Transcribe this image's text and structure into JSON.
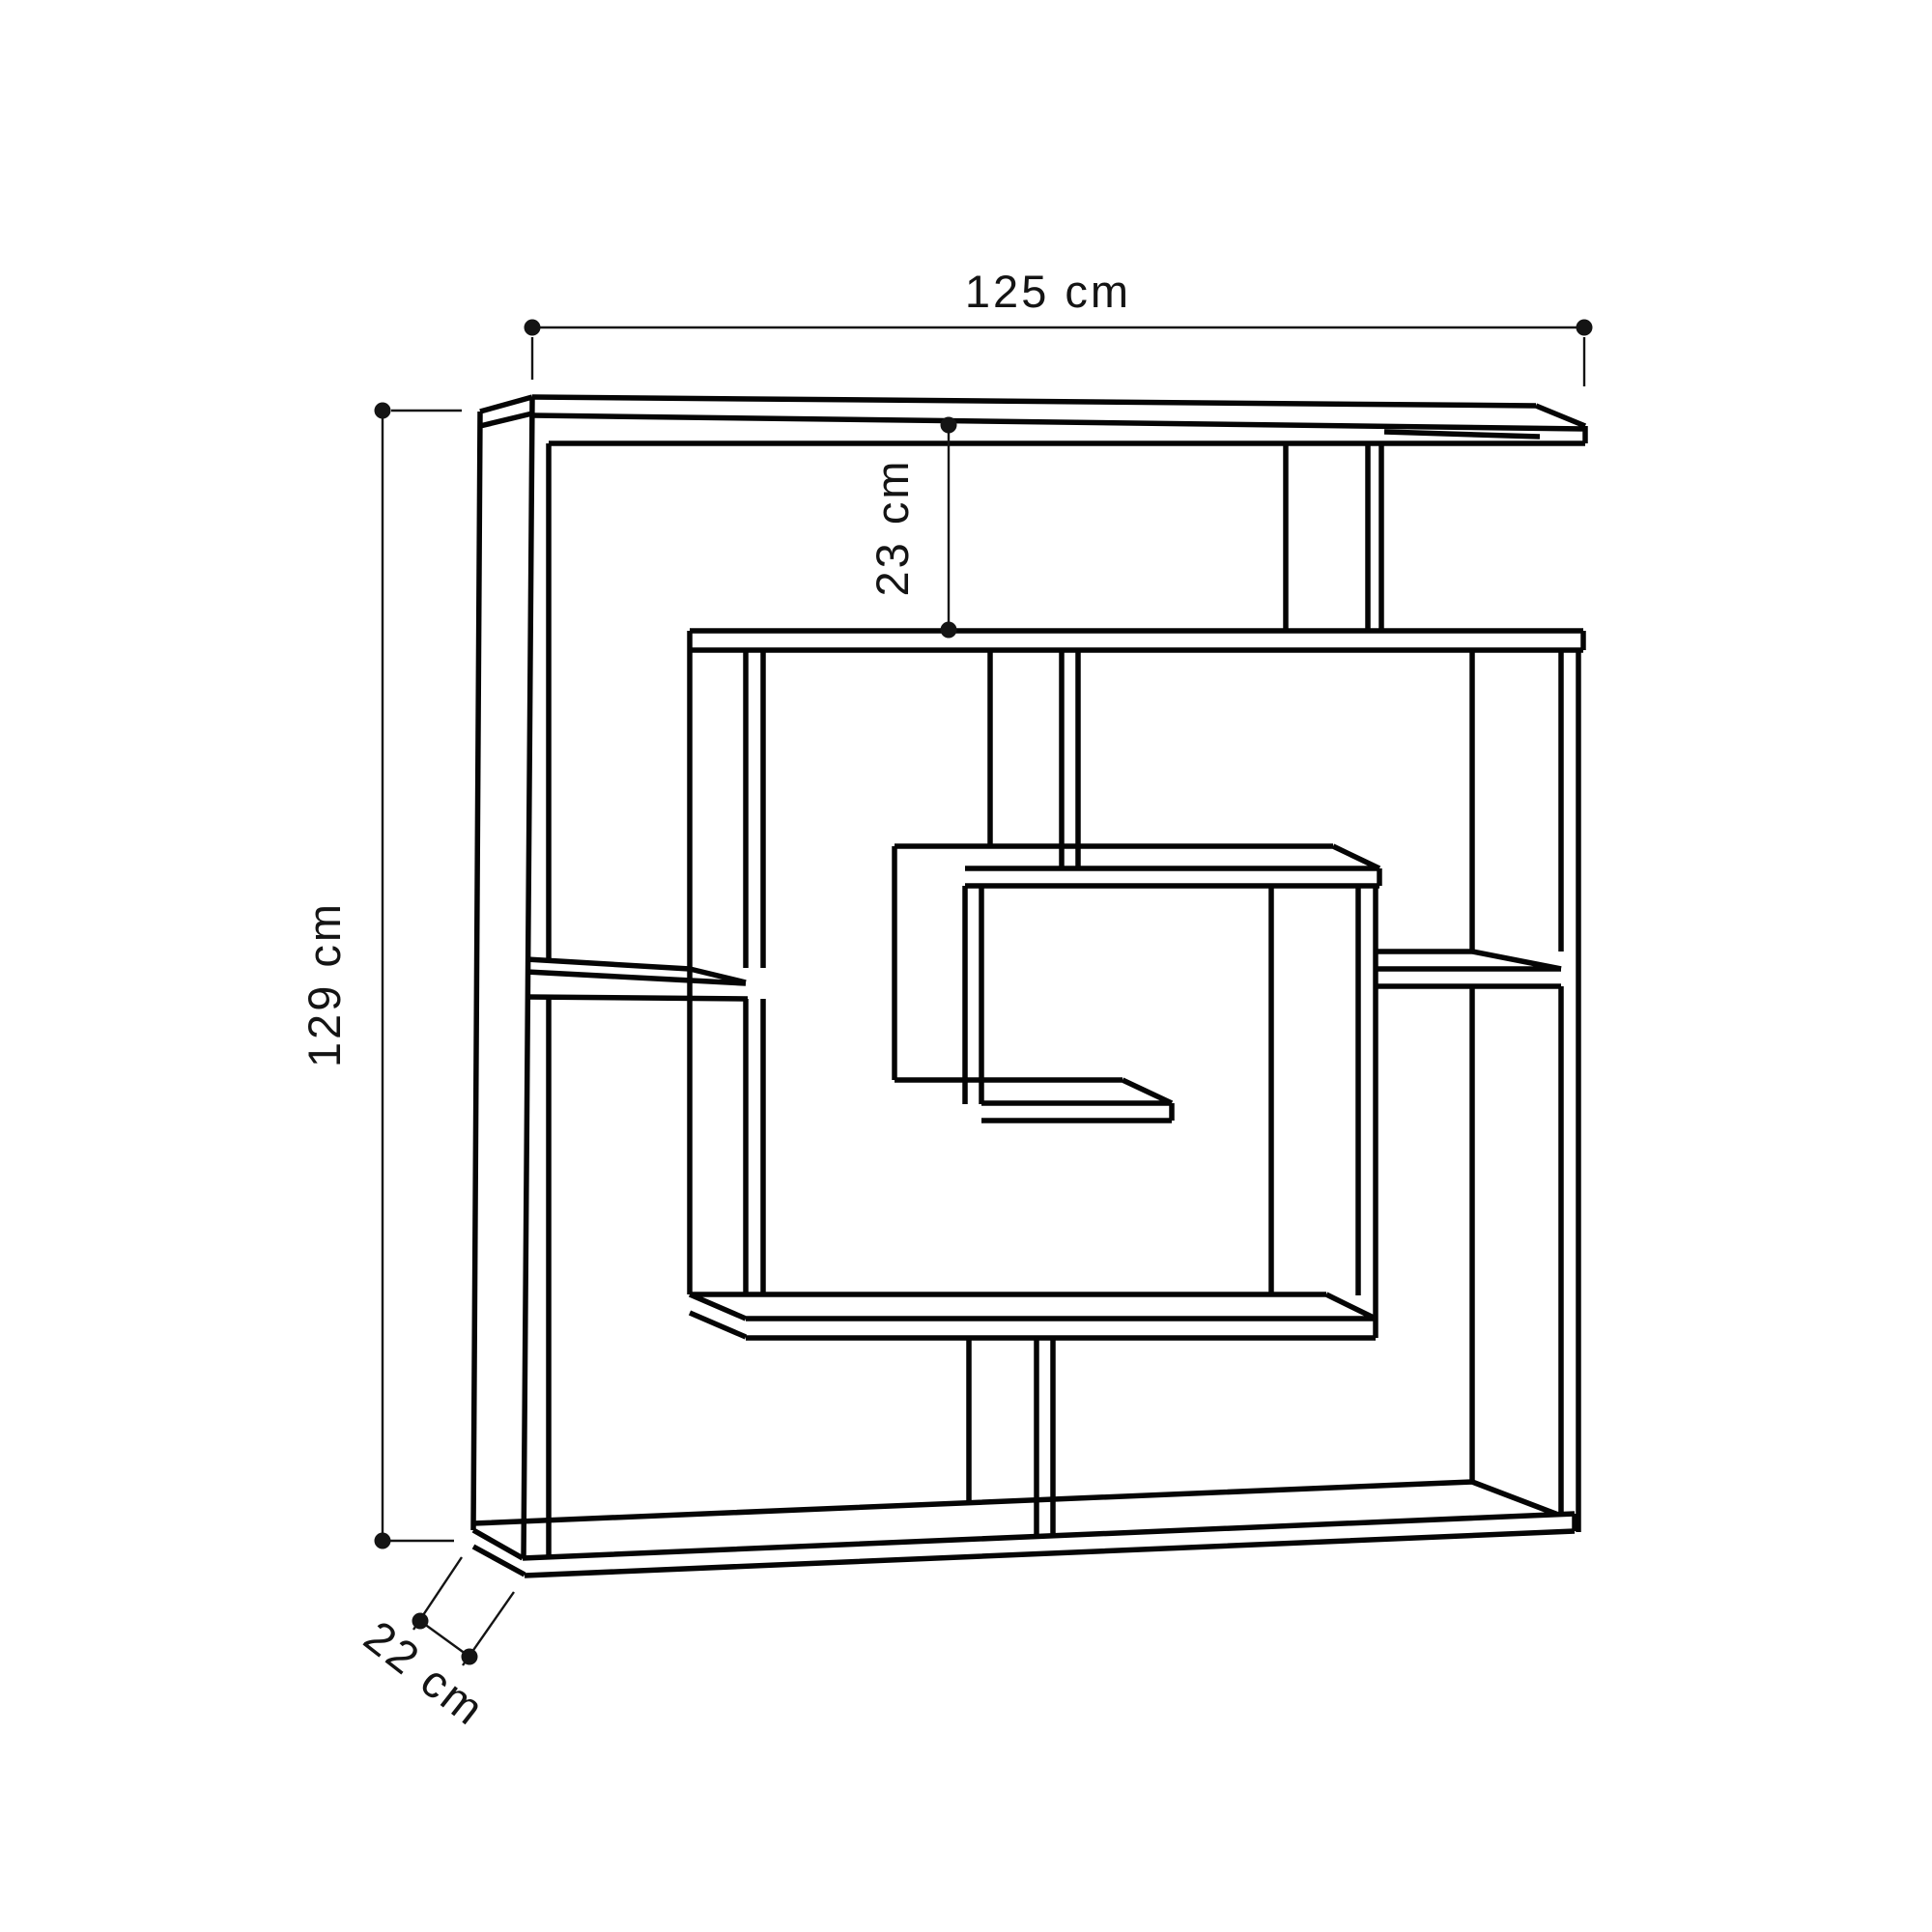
{
  "diagram": {
    "type": "furniture-dimension-drawing",
    "subject": "maze-style bookshelf front elevation",
    "dimensions": {
      "width": {
        "label": "125 cm"
      },
      "height": {
        "label": "129 cm"
      },
      "top_gap": {
        "label": "23 cm"
      },
      "depth": {
        "label": "22 cm"
      }
    },
    "colors": {
      "background": "#ffffff",
      "board_line": "#050505",
      "dimension_line": "#141414"
    }
  }
}
